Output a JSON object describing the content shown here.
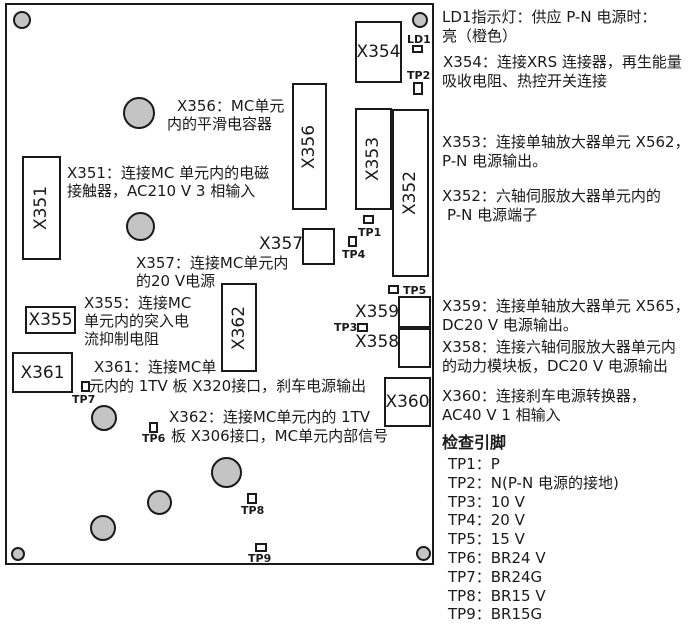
{
  "board": {
    "connectors": {
      "x351": "X351",
      "x352": "X352",
      "x353": "X353",
      "x354": "X354",
      "x355": "X355",
      "x356": "X356",
      "x358": "X358",
      "x359": "X359",
      "x360": "X360",
      "x361": "X361",
      "x362": "X362"
    },
    "floating_labels": {
      "x357": "X357",
      "x359": "X359",
      "x358": "X358"
    },
    "markers": {
      "ld1": "LD1",
      "tp1": "TP1",
      "tp2": "TP2",
      "tp3": "TP3",
      "tp4": "TP4",
      "tp5": "TP5",
      "tp6": "TP6",
      "tp7": "TP7",
      "tp8": "TP8",
      "tp9": "TP9"
    },
    "notes": {
      "x356": {
        "l1": "X356：MC单元",
        "l2": "内的平滑电容器"
      },
      "x351": {
        "l1": "X351：连接MC 单元内的电磁",
        "l2": "接触器，AC210 V 3 相输入"
      },
      "x357": {
        "l1": "X357：连接MC单元内",
        "l2": "的20 V电源"
      },
      "x355": {
        "l1": "X355：连接MC",
        "l2": "单元内的突入电",
        "l3": "流抑制电阻"
      },
      "x361": {
        "l1": "X361：连接MC单",
        "l2": "元内的 1TV 板 X320接口，刹车电源输出"
      },
      "x362": {
        "l1": "X362：连接MC单元内的 1TV",
        "l2": "板 X306接口，MC单元内部信号"
      }
    }
  },
  "legend": {
    "ld1": {
      "l1": "LD1指示灯：供应 P-N 电源时：",
      "l2": "亮（橙色）"
    },
    "x354": {
      "l1": "X354：连接XRS 连接器，再生能量",
      "l2": "吸收电阻、热控开关连接"
    },
    "x353": {
      "l1": "X353：连接单轴放大器单元 X562，",
      "l2": "P-N 电源输出。"
    },
    "x352": {
      "l1": "X352：六轴伺服放大器单元内的",
      "l2": "P-N 电源端子"
    },
    "x359": {
      "l1": "X359：连接单轴放大器单元 X565，",
      "l2": "DC20 V 电源输出。"
    },
    "x358": {
      "l1": "X358：连接六轴伺服放大器单元内",
      "l2": "的动力模块板，DC20 V 电源输出"
    },
    "x360": {
      "l1": "X360：连接刹车电源转换器，",
      "l2": "AC40 V 1 相输入"
    },
    "check_pins_header": "检查引脚",
    "pins": [
      {
        "id": "TP1",
        "value": "P",
        "line": "TP1：P"
      },
      {
        "id": "TP2",
        "value": "N(P-N 电源的接地)",
        "line": "TP2：N(P-N 电源的接地)"
      },
      {
        "id": "TP3",
        "value": "10 V",
        "line": "TP3：10 V"
      },
      {
        "id": "TP4",
        "value": "20 V",
        "line": "TP4：20 V"
      },
      {
        "id": "TP5",
        "value": "15 V",
        "line": "TP5：15 V"
      },
      {
        "id": "TP6",
        "value": "BR24 V",
        "line": "TP6：BR24 V"
      },
      {
        "id": "TP7",
        "value": "BR24G",
        "line": "TP7：BR24G"
      },
      {
        "id": "TP8",
        "value": "BR15 V",
        "line": "TP8：BR15 V"
      },
      {
        "id": "TP9",
        "value": "BR15G",
        "line": "TP9：BR15G"
      }
    ]
  },
  "colors": {
    "line": "#1a1a1a",
    "component_fill": "#c4c4c4",
    "background": "#ffffff"
  }
}
